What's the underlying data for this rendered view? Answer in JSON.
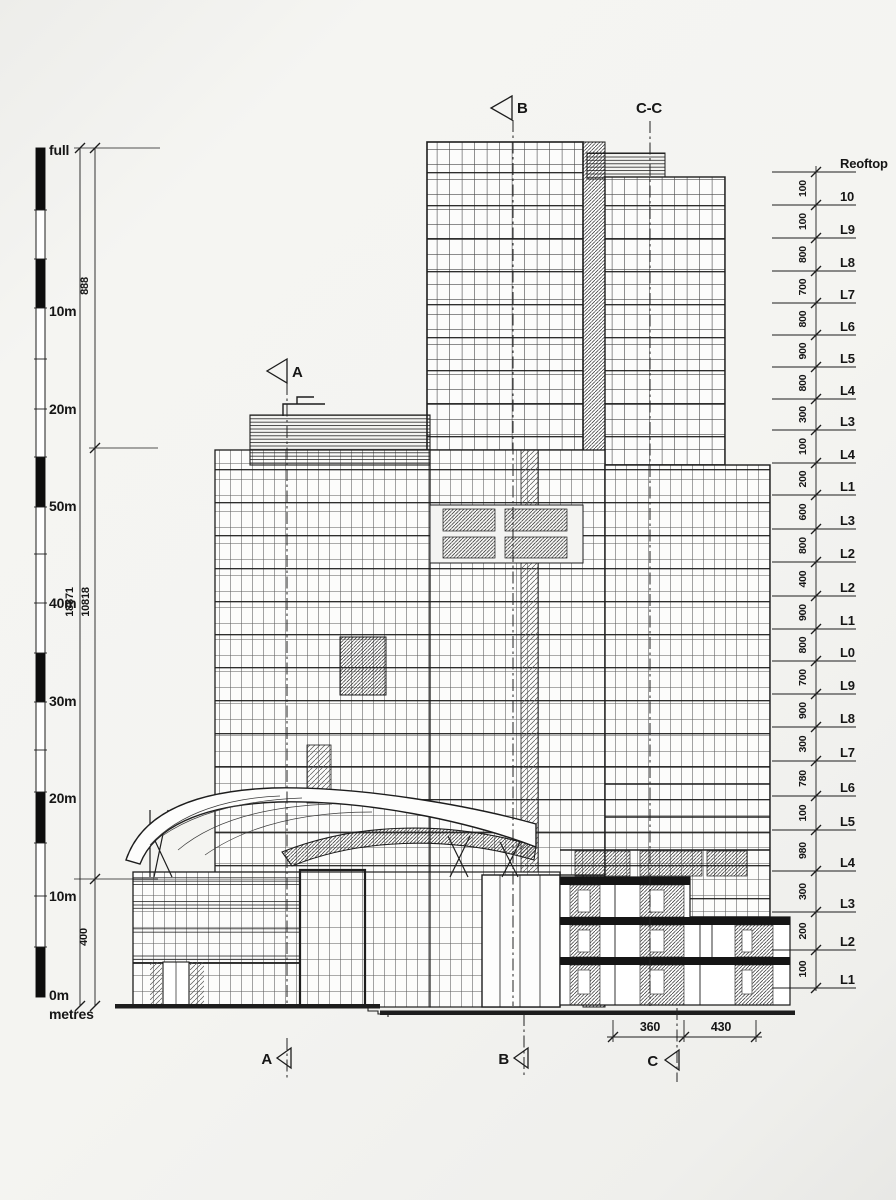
{
  "scalebar": {
    "labels": [
      {
        "text": "full",
        "y": 150
      },
      {
        "text": "10m",
        "y": 311
      },
      {
        "text": "20m",
        "y": 409
      },
      {
        "text": "50m",
        "y": 506
      },
      {
        "text": "40m",
        "y": 603
      },
      {
        "text": "30m",
        "y": 701
      },
      {
        "text": "20m",
        "y": 798
      },
      {
        "text": "10m",
        "y": 896
      },
      {
        "text": "0m",
        "y": 995
      },
      {
        "text": "metres",
        "y": 1014
      }
    ]
  },
  "left_dimensions": [
    {
      "value": "888",
      "x": 88,
      "y": 286
    },
    {
      "value": "18871",
      "x": 73,
      "y": 602
    },
    {
      "value": "10818",
      "x": 89,
      "y": 602
    },
    {
      "value": "400",
      "x": 87,
      "y": 937
    }
  ],
  "levels": [
    {
      "label": "Reoftop",
      "y": 172,
      "dim": null
    },
    {
      "label": "10",
      "y": 205,
      "dim": "100"
    },
    {
      "label": "L9",
      "y": 238,
      "dim": "100"
    },
    {
      "label": "L8",
      "y": 271,
      "dim": "800"
    },
    {
      "label": "L7",
      "y": 303,
      "dim": "700"
    },
    {
      "label": "L6",
      "y": 335,
      "dim": "800"
    },
    {
      "label": "L5",
      "y": 367,
      "dim": "900"
    },
    {
      "label": "L4",
      "y": 399,
      "dim": "800"
    },
    {
      "label": "L3",
      "y": 430,
      "dim": "300"
    },
    {
      "label": "L4",
      "y": 463,
      "dim": "100"
    },
    {
      "label": "L1",
      "y": 495,
      "dim": "200"
    },
    {
      "label": "L3",
      "y": 529,
      "dim": "600"
    },
    {
      "label": "L2",
      "y": 562,
      "dim": "800"
    },
    {
      "label": "L2",
      "y": 596,
      "dim": "400"
    },
    {
      "label": "L1",
      "y": 629,
      "dim": "900"
    },
    {
      "label": "L0",
      "y": 661,
      "dim": "800"
    },
    {
      "label": "L9",
      "y": 694,
      "dim": "700"
    },
    {
      "label": "L8",
      "y": 727,
      "dim": "900"
    },
    {
      "label": "L7",
      "y": 761,
      "dim": "300"
    },
    {
      "label": "L6",
      "y": 796,
      "dim": "780"
    },
    {
      "label": "L5",
      "y": 830,
      "dim": "100"
    },
    {
      "label": "L4",
      "y": 871,
      "dim": "980"
    },
    {
      "label": "L3",
      "y": 912,
      "dim": "300"
    },
    {
      "label": "L2",
      "y": 950,
      "dim": "200"
    },
    {
      "label": "L1",
      "y": 988,
      "dim": "100"
    }
  ],
  "section_markers": {
    "top": [
      {
        "label": "B",
        "tx": 517,
        "ty": 113,
        "anchor": "start",
        "tri": "512,96 491,108 512,120",
        "lx": 513,
        "ly1": 120,
        "ly2": 1006
      },
      {
        "label": "C-C",
        "tx": 649,
        "ty": 113,
        "anchor": "middle",
        "tri": "",
        "lx": 650,
        "ly1": 121,
        "ly2": 1006
      },
      {
        "label": "A",
        "tx": 292,
        "ty": 377,
        "anchor": "start",
        "tri": "287,359 267,371 287,383",
        "lx": 287,
        "ly1": 383,
        "ly2": 1006
      }
    ],
    "bottom": [
      {
        "label": "A",
        "tx": 272,
        "ty": 1064,
        "anchor": "end",
        "tri": "291,1048 277,1058 291,1068",
        "lx": 287,
        "ly1": 1038,
        "ly2": 1078
      },
      {
        "label": "B",
        "tx": 509,
        "ty": 1064,
        "anchor": "end",
        "tri": "528,1048 514,1058 528,1068",
        "lx": 524,
        "ly1": 1014,
        "ly2": 1078
      },
      {
        "label": "C",
        "tx": 658,
        "ty": 1066,
        "anchor": "end",
        "tri": "679,1050 665,1060 679,1070",
        "lx": 677,
        "ly1": 1008,
        "ly2": 1082
      }
    ]
  },
  "bottom_dimensions": {
    "y": 1037,
    "ticks": [
      613,
      684,
      756
    ],
    "labels": [
      {
        "value": "360",
        "x": 650
      },
      {
        "value": "430",
        "x": 721
      }
    ]
  }
}
